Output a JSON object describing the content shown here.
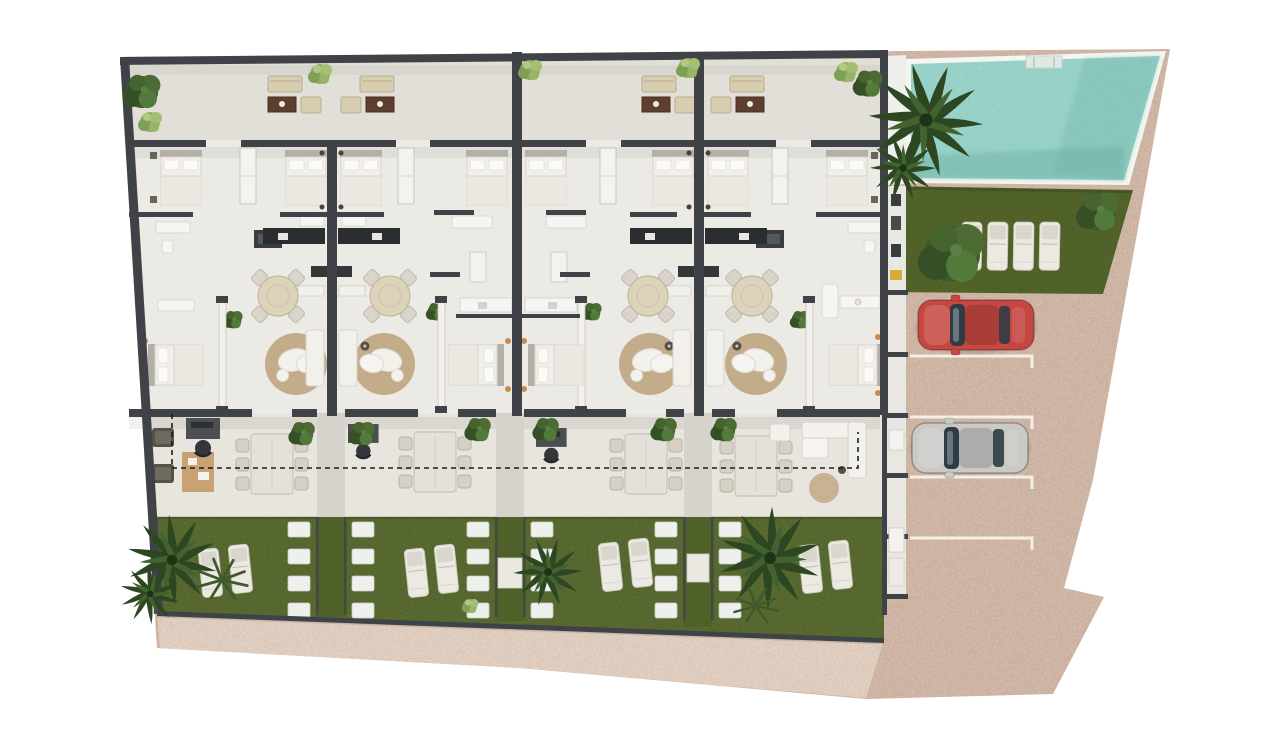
{
  "palette": {
    "background": "#ffffff",
    "paving": "#d5bcac",
    "paving_speckle": "#a98a77",
    "walkway": "#e4d4c6",
    "wall": "#3f4347",
    "floor_terrace": "#e2dfd9",
    "floor_interior": "#eceae4",
    "floor_porch": "#e8e5de",
    "path": "#d6d3cc",
    "pool_water": "#8accc2",
    "pool_shadow": "#6fb3a6",
    "pool_rim": "#f4f6f2",
    "pool_step": "#dfe9e3",
    "lawn_private": "#5e7034",
    "lawn_path": "#4f6128",
    "lawn_communal": "#57682c",
    "hedge": "#46551f",
    "rug": "#c3ac8a",
    "sofa_white": "#f3f1ec",
    "bench_white": "#f2f0ea",
    "wood_dark": "#5d3e2f",
    "upholstery_cream": "#d7cdb0",
    "stepping_stone": "#eef0ed",
    "lounger": "#ebe9e2",
    "lounger_pad": "#d9d6cd",
    "car_red": "#c64742",
    "car_silver": "#c9c9c6",
    "glass": "#303b43",
    "stall_line": "#f2efe8",
    "counter_dark": "#2b2e31",
    "fixture_white": "#f6f5f1",
    "shower_dark": "#3a3d40",
    "desk_dark": "#4b4f53",
    "mat_tan": "#c49a66",
    "accent_yellow": "#d4ac38",
    "lamp_orange": "#c98a4b",
    "foliage_dark": "#3f5c2c",
    "foliage_light": "#9db86f",
    "palm_green": "#2c4722"
  },
  "site": {
    "townhouse_units": 4,
    "unit_features": {
      "top_terrace_lounge_sets": 1,
      "beds_visible_per_unit": 3,
      "round_dining_seats": 4,
      "patio_dining_seats": 6,
      "garden_sun_loungers": 2,
      "stepping_stone_path_per_boundary": true
    },
    "shared_amenities": {
      "swimming_pool": true,
      "pool_step_entries": 1,
      "communal_lawn_sun_loungers": 4,
      "parking_stalls": 4,
      "parked_cars": [
        {
          "stall": 1,
          "color_name": "red"
        },
        {
          "stall": 3,
          "color_name": "silver"
        }
      ]
    },
    "landscaping": {
      "palm_trees": 6,
      "round_trees_and_shrubs": 14,
      "stepping_stone_paths": 3,
      "private_gardens": 4
    }
  }
}
